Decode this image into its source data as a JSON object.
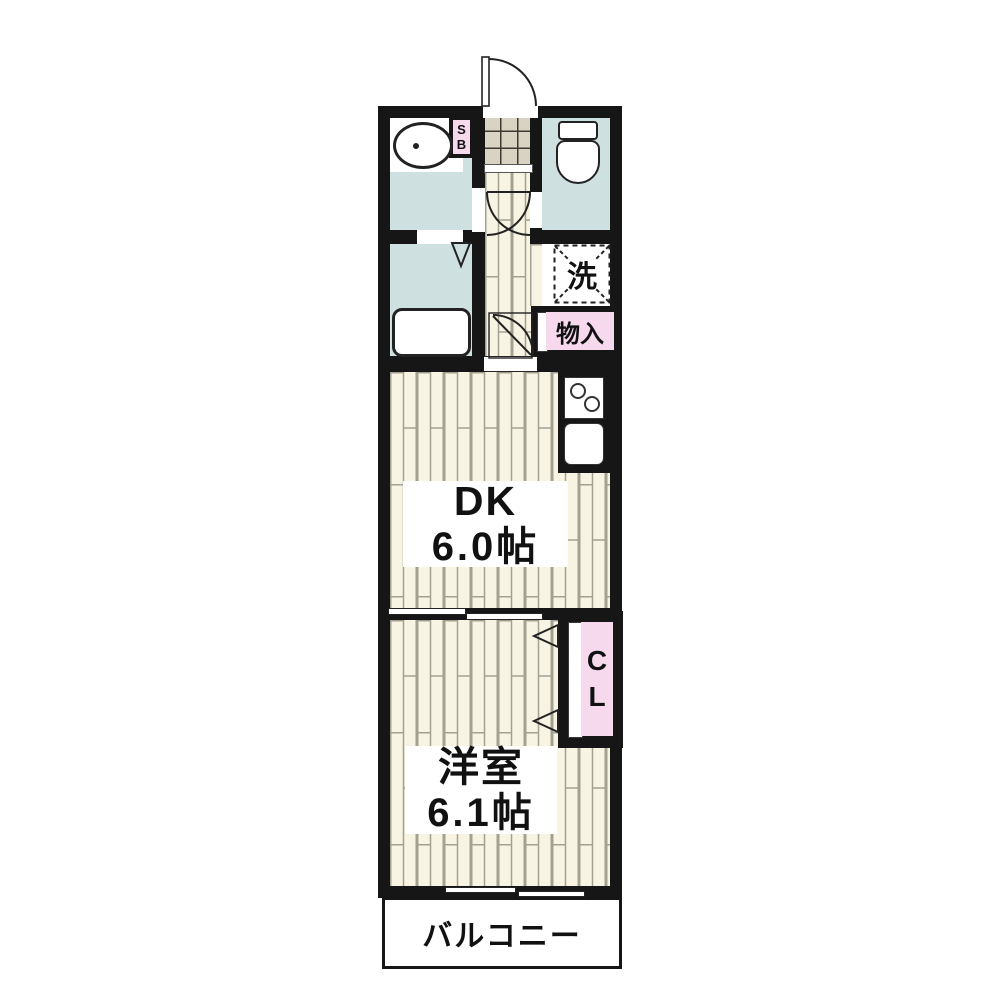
{
  "labels": {
    "dk_name": "DK",
    "dk_size": "6.0帖",
    "western_name": "洋室",
    "western_size": "6.1帖",
    "balcony": "バルコニー",
    "laundry": "洗",
    "storage": "物入",
    "closet_c": "C",
    "closet_l": "L",
    "shoebox_s": "S",
    "shoebox_b": "B"
  },
  "colors": {
    "wall": "#161616",
    "water_room": "#cfe0e1",
    "wood_floor": "#f7f4e3",
    "wood_line": "#a3a191",
    "tile": "#d9d3c3",
    "tile_line": "#3c3a33",
    "accent_pink": "#f6d9ec",
    "line": "#222222"
  }
}
